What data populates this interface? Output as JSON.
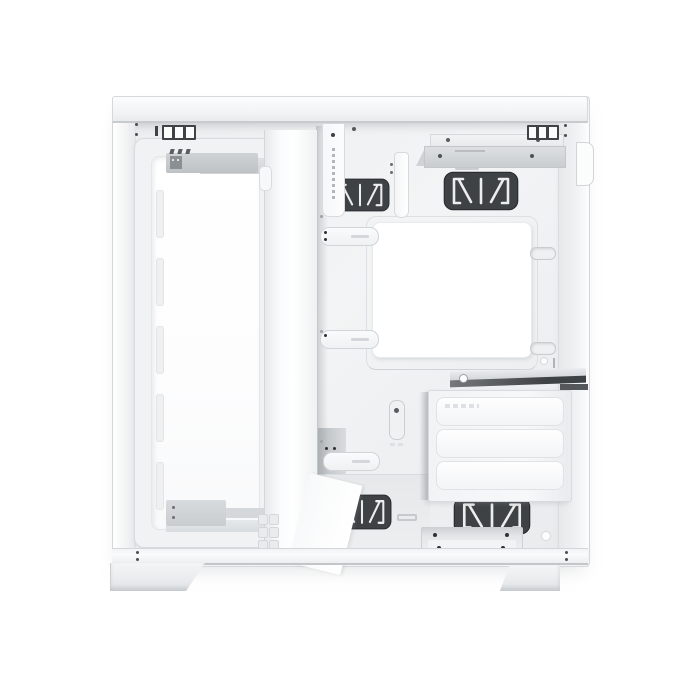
{
  "scene": {
    "description": "White mid-tower dual-chamber PC case, right side view with side and front panels removed, showing interior frame on white background",
    "background_color": "#ffffff"
  },
  "palette": {
    "bg": "#ffffff",
    "case_white": "#f3f4f5",
    "bright_white": "#ffffff",
    "panel_light": "#fafbfc",
    "edge_light": "#e3e5e7",
    "edge_mid": "#d2d5d8",
    "shadow_gray": "#b9bdc0",
    "tray_gray": "#edeff0",
    "metal_gray": "#c9cccf",
    "grommet_dark": "#3e4245",
    "grommet_line": "#eceded",
    "detail_dark": "#2e3134"
  },
  "parts": {
    "case": "white PC case chassis",
    "top_panel": "top panel edge",
    "bottom_rail": "bottom panel edge",
    "front_bracket": "front fan and radiator bracket",
    "front_opening": "front bracket opening",
    "spine": "center divider column",
    "tray": "motherboard tray",
    "cpu_cutout": "CPU cooler backplate cutout",
    "grommet": "cable routing grommet",
    "ssd_bracket": "top SSD mounting bracket",
    "drive_cage": "three-bay drive cage",
    "drive_tray": "drive tray",
    "gpu_support": "GPU support ledge",
    "tab": "inner tab with micro markings",
    "clip": "cable clip",
    "rail_clip": "mounting rail clip",
    "slot": "vent slot",
    "screw": "screw hole",
    "latch": "rear panel latch",
    "foot_left": "front case foot",
    "foot_right": "rear case foot"
  }
}
